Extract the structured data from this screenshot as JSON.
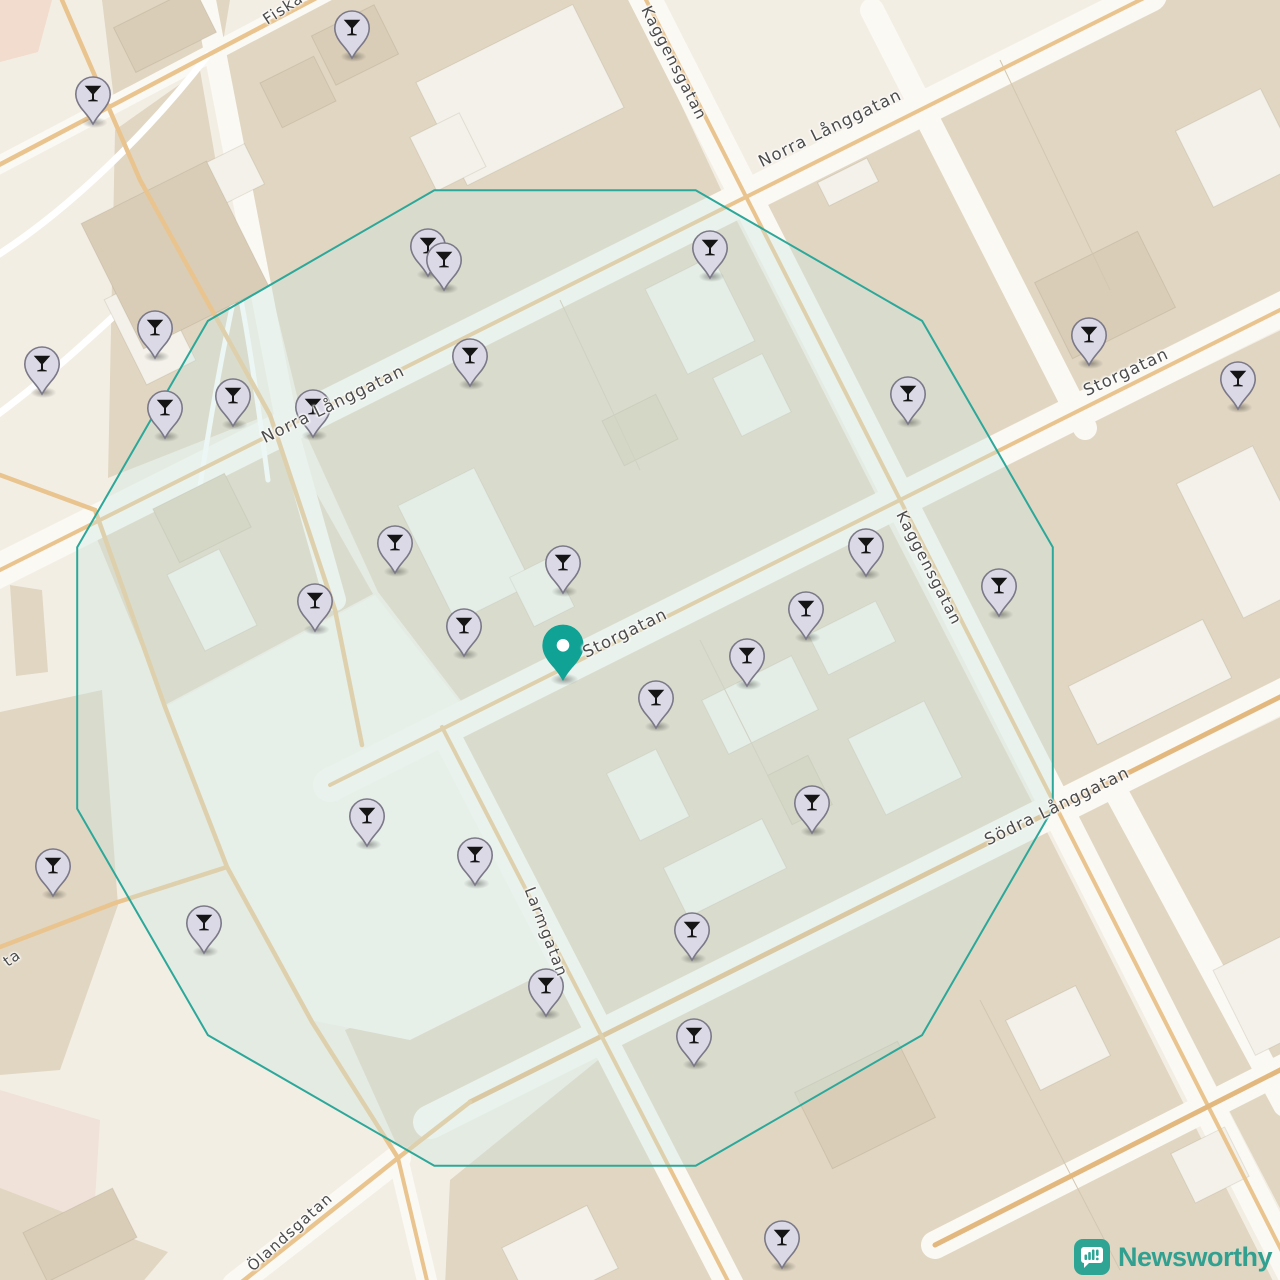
{
  "map": {
    "street_labels": [
      {
        "text": "Fiskaregatan",
        "x": 312,
        "y": -10,
        "rotation": -33,
        "size": 15.5
      },
      {
        "text": "Kaggensgatan",
        "x": 674,
        "y": 63,
        "rotation": 63,
        "size": 15.5
      },
      {
        "text": "Norra Långgatan",
        "x": 333,
        "y": 404,
        "rotation": -26,
        "size": 16.5
      },
      {
        "text": "Norra Långgatan",
        "x": 830,
        "y": 128,
        "rotation": -26,
        "size": 16.5
      },
      {
        "text": "Storgatan",
        "x": 625,
        "y": 633,
        "rotation": -26,
        "size": 16.5
      },
      {
        "text": "Storgatan",
        "x": 1126,
        "y": 372,
        "rotation": -25,
        "size": 16.5
      },
      {
        "text": "Kaggensgatan",
        "x": 929,
        "y": 568,
        "rotation": 63,
        "size": 15.5
      },
      {
        "text": "Södra Långgatan",
        "x": 1057,
        "y": 806,
        "rotation": -26,
        "size": 16.5
      },
      {
        "text": "Larmgatan",
        "x": 546,
        "y": 932,
        "rotation": 69,
        "size": 15.5
      },
      {
        "text": "Ölandsgatan",
        "x": 290,
        "y": 1232,
        "rotation": -42,
        "size": 15
      },
      {
        "text": "ta",
        "x": 12,
        "y": 958,
        "rotation": -35,
        "size": 15
      }
    ],
    "markers": {
      "venue_icon": "cocktail-glass-icon",
      "venues": [
        {
          "x": 93,
          "y": 124
        },
        {
          "x": 352,
          "y": 58
        },
        {
          "x": 428,
          "y": 276
        },
        {
          "x": 444,
          "y": 290
        },
        {
          "x": 710,
          "y": 278
        },
        {
          "x": 155,
          "y": 358
        },
        {
          "x": 42,
          "y": 394
        },
        {
          "x": 165,
          "y": 438
        },
        {
          "x": 233,
          "y": 426
        },
        {
          "x": 313,
          "y": 437
        },
        {
          "x": 470,
          "y": 386
        },
        {
          "x": 908,
          "y": 424
        },
        {
          "x": 1089,
          "y": 365
        },
        {
          "x": 1238,
          "y": 409
        },
        {
          "x": 395,
          "y": 573
        },
        {
          "x": 563,
          "y": 593
        },
        {
          "x": 315,
          "y": 631
        },
        {
          "x": 464,
          "y": 656
        },
        {
          "x": 866,
          "y": 576
        },
        {
          "x": 999,
          "y": 616
        },
        {
          "x": 806,
          "y": 639
        },
        {
          "x": 747,
          "y": 686
        },
        {
          "x": 656,
          "y": 728
        },
        {
          "x": 812,
          "y": 833
        },
        {
          "x": 367,
          "y": 846
        },
        {
          "x": 53,
          "y": 896
        },
        {
          "x": 475,
          "y": 885
        },
        {
          "x": 204,
          "y": 953
        },
        {
          "x": 692,
          "y": 960
        },
        {
          "x": 546,
          "y": 1016
        },
        {
          "x": 694,
          "y": 1066
        },
        {
          "x": 782,
          "y": 1268
        }
      ],
      "center": {
        "x": 563,
        "y": 681
      }
    },
    "radius_overlay": {
      "cx": 565,
      "cy": 678,
      "radius": 505,
      "sides": 12,
      "stroke": "#2ca89a",
      "stroke_width": 2,
      "fill": "rgba(201,230,224,0.36)"
    },
    "colors": {
      "pin_fill": "#dcd9e7",
      "pin_border": "#7b7887",
      "pin_glyph": "#151515",
      "center_pin_fill": "#10a294",
      "label_color": "#4b4b4b"
    }
  },
  "branding": {
    "logo_text": "Newsworthy",
    "logo_color": "#31a090",
    "logo_icon_bg": "#2ea594"
  }
}
